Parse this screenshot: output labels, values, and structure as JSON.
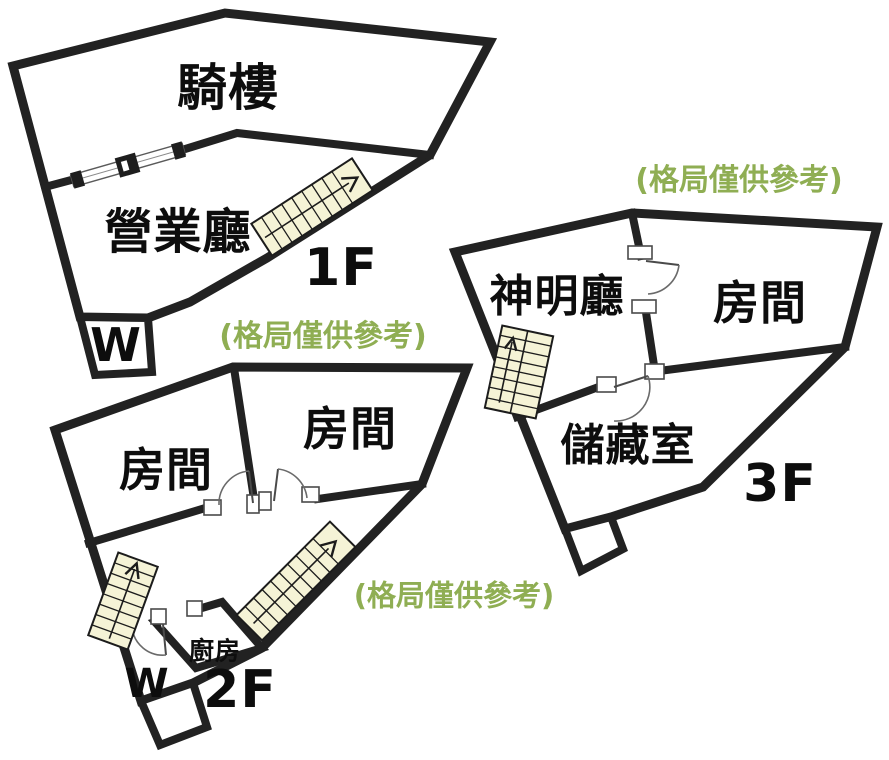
{
  "image": {
    "width": 889,
    "height": 760,
    "background": "#ffffff"
  },
  "colors": {
    "wall": "#222222",
    "stair_fill": "#f5f3d6",
    "note_green": "#8fae53",
    "text": "#0d0d0d",
    "door_outline": "#4a4a4a"
  },
  "floors": {
    "f1": {
      "floor_label": "1F",
      "rooms": {
        "arcade": "騎樓",
        "business_hall": "營業廳",
        "wc": "W"
      },
      "note": "(格局僅供參考)"
    },
    "f2": {
      "floor_label": "2F",
      "rooms": {
        "room_left": "房間",
        "room_right": "房間",
        "kitchen": "廚房",
        "wc": "W"
      },
      "note": "(格局僅供參考)"
    },
    "f3": {
      "floor_label": "3F",
      "rooms": {
        "shrine_hall": "神明廳",
        "room": "房間",
        "storage": "儲藏室"
      },
      "note": "(格局僅供參考)"
    }
  }
}
